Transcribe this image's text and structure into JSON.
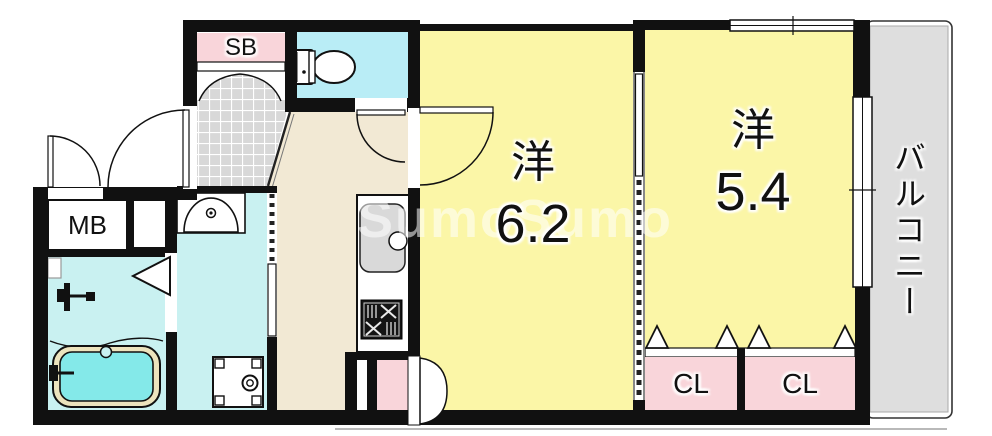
{
  "plan": {
    "watermark": "SumoSumo",
    "labels": {
      "shoe_box": "SB",
      "meter_box": "MB",
      "closet_1": "CL",
      "closet_2": "CL",
      "balcony": "バルコニー"
    },
    "rooms": [
      {
        "type": "洋",
        "size": "6.2"
      },
      {
        "type": "洋",
        "size": "5.4"
      }
    ],
    "colors": {
      "wall": "#111111",
      "room-yellow": "#fbf6a7",
      "kitchen-beige": "#f2e9d4",
      "wet-cyan": "#c9f1f1",
      "toilet-cyan": "#b9edf6",
      "tub-cyan": "#84e9e9",
      "tub-rim": "#ece3bd",
      "storage-pink": "#f9d5da",
      "tile-grey": "#d8d8d8",
      "balcony-grey": "#dedede",
      "sink-grey": "#d9d9d9"
    }
  }
}
